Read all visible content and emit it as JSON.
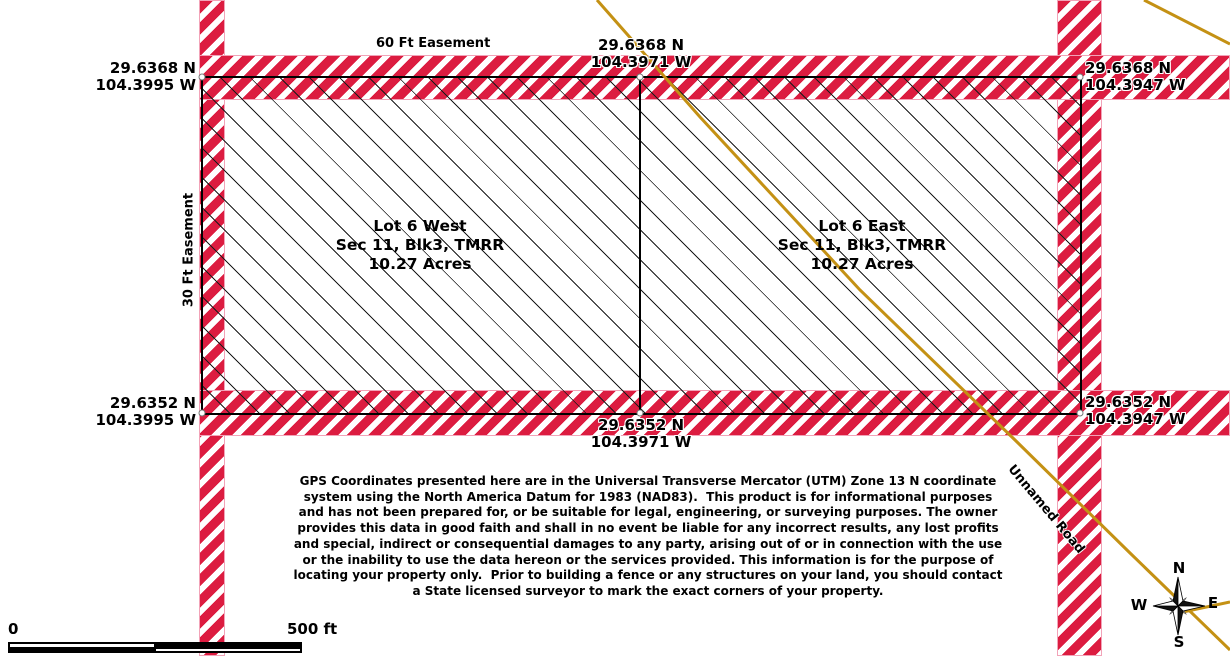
{
  "corners": {
    "nw": {
      "lat": "29.6368 N",
      "lon": "104.3995 W"
    },
    "n": {
      "lat": "29.6368 N",
      "lon": "104.3971 W"
    },
    "ne": {
      "lat": "29.6368 N",
      "lon": "104.3947 W"
    },
    "sw": {
      "lat": "29.6352 N",
      "lon": "104.3995 W"
    },
    "s": {
      "lat": "29.6352 N",
      "lon": "104.3971 W"
    },
    "se": {
      "lat": "29.6352 N",
      "lon": "104.3947 W"
    }
  },
  "easements": {
    "top": "60 Ft Easement",
    "left": "30 Ft Easement"
  },
  "lots": {
    "west": {
      "name": "Lot 6 West",
      "block": "Sec 11, Blk3, TMRR",
      "acres": "10.27 Acres"
    },
    "east": {
      "name": "Lot 6 East",
      "block": "Sec 11, Blk3, TMRR",
      "acres": "10.27 Acres"
    }
  },
  "road": {
    "name": "Unnamed Road"
  },
  "compass": {
    "north": "N",
    "east": "E",
    "south": "S",
    "west": "W"
  },
  "scale_bar": {
    "zero": "0",
    "end": "500 ft"
  },
  "disclaimer": "GPS Coordinates presented here are in the Universal Transverse Mercator (UTM) Zone 13 N coordinate\nsystem using the North America Datum for 1983 (NAD83).  This product is for informational purposes\nand has not been prepared for, or be suitable for legal, engineering, or surveying purposes. The owner\nprovides this data in good faith and shall in no event be liable for any incorrect results, any lost profits\nand special, indirect or consequential damages to any party, arising out of or in connection with the use\nor the inability to use the data hereon or the services provided. This information is for the purpose of\nlocating your property only.  Prior to building a fence or any structures on your land, you should contact\na State licensed surveyor to mark the exact corners of your property.",
  "colors": {
    "stripe_red": "#DC1C40",
    "stripe_edge": "#F2A3B8",
    "road_gold": "#C49114"
  }
}
